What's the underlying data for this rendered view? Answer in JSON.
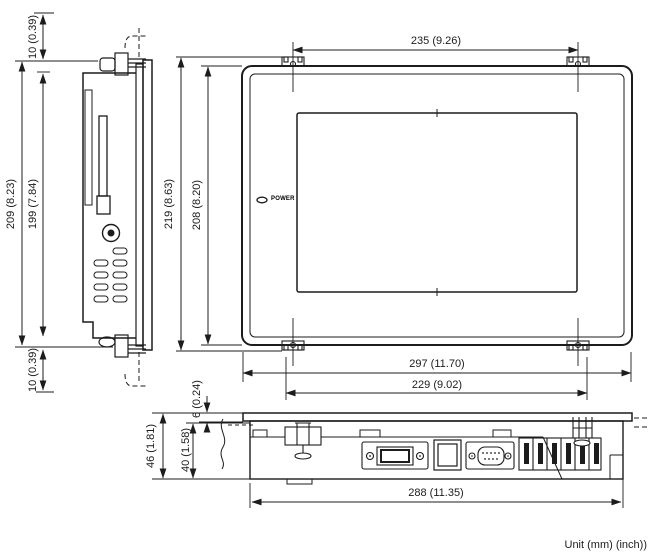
{
  "drawing": {
    "unit_note": "Unit (mm) (inch))",
    "front_view": {
      "power_led_label": "POWER"
    },
    "dims": {
      "clearance_top": "10 (0.39)",
      "overall_height_side": "209 (8.23)",
      "body_height_side": "199 (7.84)",
      "clearance_bottom": "10 (0.39)",
      "mount_width_top": "235 (9.26)",
      "overall_height_front": "219 (8.63)",
      "panel_height_front": "208 (8.20)",
      "overall_width_front": "297 (11.70)",
      "mount_width_bottom": "229 (9.02)",
      "bezel_depth": "6 (0.24)",
      "overall_depth": "46 (1.81)",
      "body_depth": "40 (1.58)",
      "overall_width_bottom": "288 (11.35)"
    },
    "colors": {
      "line": "#1c1c1c",
      "background": "#ffffff"
    }
  }
}
